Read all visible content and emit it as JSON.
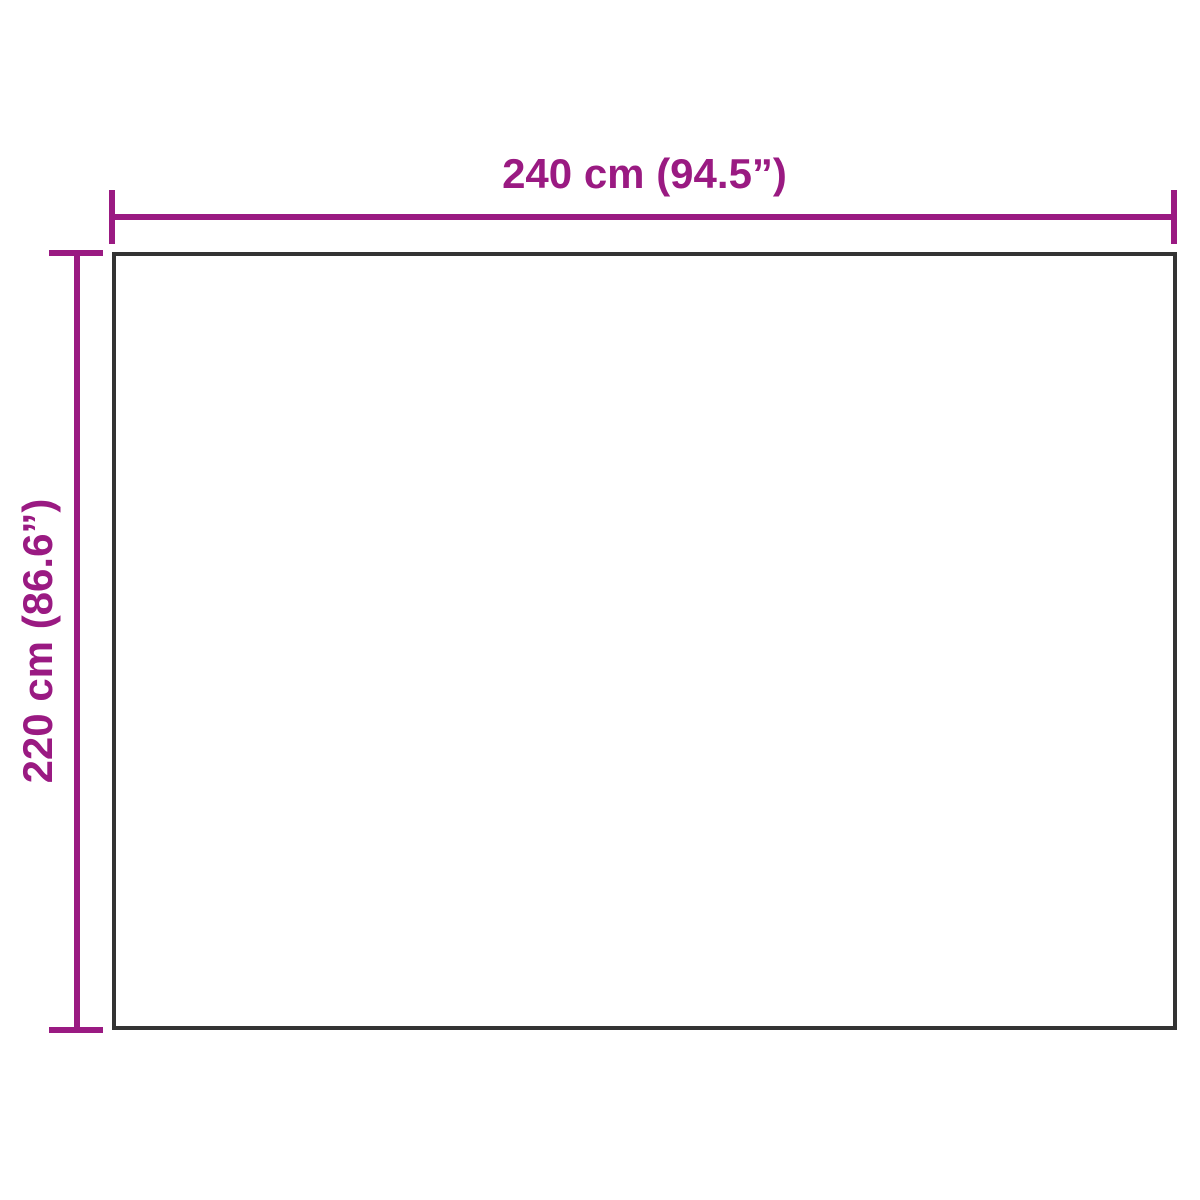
{
  "diagram": {
    "width_label": "240 cm (94.5”)",
    "height_label": "220 cm (86.6”)",
    "width_cm": 240,
    "width_inches": 94.5,
    "height_cm": 220,
    "height_inches": 86.6
  },
  "colors": {
    "accent": "#9A1A82",
    "outline": "#333333",
    "background": "#FFFFFF"
  }
}
